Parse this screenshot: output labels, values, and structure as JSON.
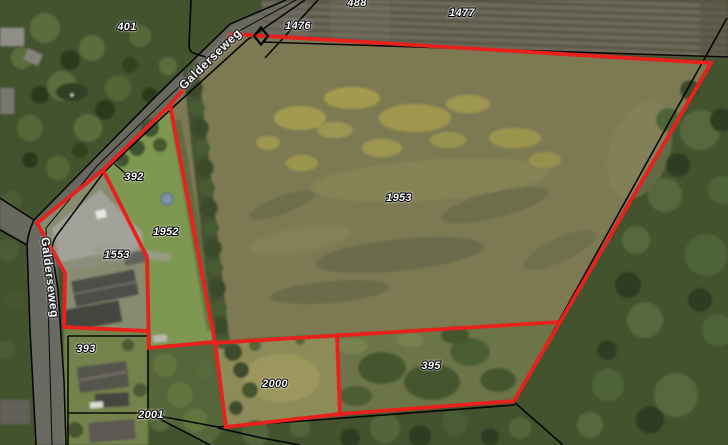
{
  "map": {
    "road_labels": {
      "upper_diagonal": "Galderseweg",
      "lower_vertical": "Galderseweg"
    },
    "parcel_labels": {
      "p401": "401",
      "p488": "488",
      "p1476": "1476",
      "p1477": "1477",
      "p392": "392",
      "p1952": "1952",
      "p1553": "1553",
      "p1953": "1953",
      "p393": "393",
      "p2000": "2000",
      "p2001": "2001",
      "p395": "395"
    },
    "colors": {
      "boundary_red": "#e9211d",
      "cadastral_line": "#000000",
      "label_fill": "#ffffff",
      "label_outline": "#000000"
    },
    "marker": {
      "survey_point": "diamond-outline"
    }
  }
}
